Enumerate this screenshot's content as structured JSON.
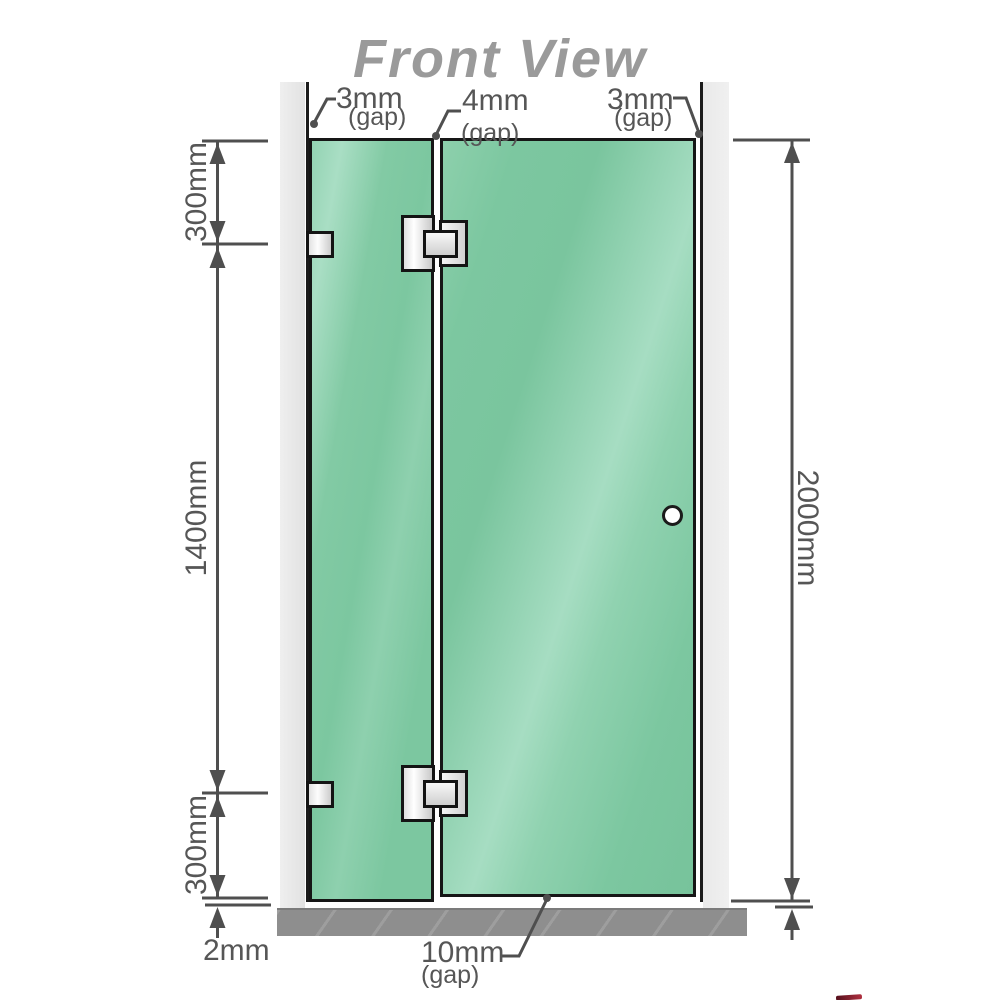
{
  "title": "Front View",
  "top_labels": {
    "left": {
      "value": "3mm",
      "gap": "(gap)"
    },
    "middle": {
      "value": "4mm",
      "gap": "(gap)"
    },
    "right": {
      "value": "3mm",
      "gap": "(gap)"
    }
  },
  "left_dimensions": {
    "top": "300mm",
    "middle": "1400mm",
    "bottom": "300mm",
    "floor": "2mm"
  },
  "right_dimension": {
    "height": "2000mm"
  },
  "bottom_label": {
    "value": "10mm",
    "gap": "(gap)"
  },
  "colors": {
    "glass": "#7cc7a0",
    "glass_highlight": "#a9dec4",
    "wall": "#e9e9e9",
    "floor": "#8e8e8e",
    "dimension_line": "#4f4f4f",
    "outline": "#161616",
    "title_gray": "#9a9a9a",
    "hinge_metal": "#e8e8e8"
  }
}
